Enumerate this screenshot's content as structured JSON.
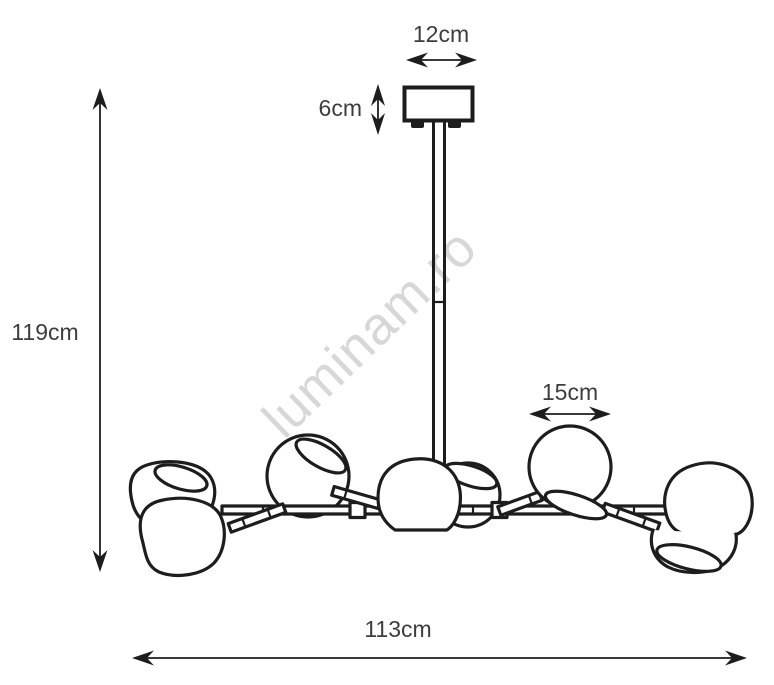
{
  "watermark": {
    "text": "luminam.ro",
    "color": "#d7d7d7"
  },
  "drawing": {
    "line_color": "#1d1d1d",
    "label_color": "#3d3d3d",
    "background": "#ffffff"
  },
  "dimensions": [
    {
      "id": "canopy-width",
      "label": "12cm",
      "orientation": "horizontal"
    },
    {
      "id": "canopy-height",
      "label": "6cm",
      "orientation": "vertical"
    },
    {
      "id": "overall-height",
      "label": "119cm",
      "orientation": "vertical"
    },
    {
      "id": "shade-diameter",
      "label": "15cm",
      "orientation": "horizontal"
    },
    {
      "id": "overall-width",
      "label": "113cm",
      "orientation": "horizontal"
    }
  ]
}
